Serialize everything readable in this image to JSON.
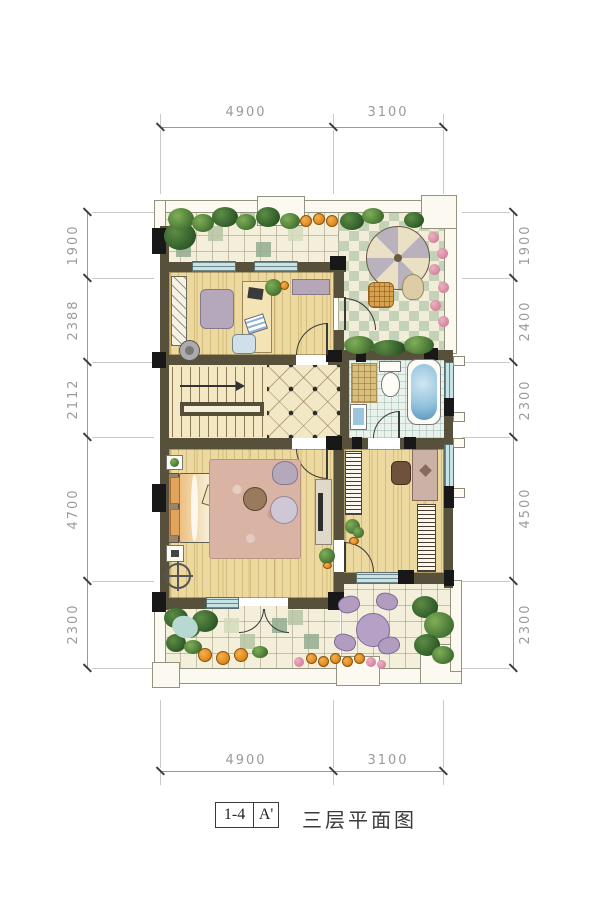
{
  "title": {
    "index_label": "1-4",
    "section_label": "A'",
    "plan_name": "三层平面图"
  },
  "dimensions": {
    "top": [
      "4900",
      "3100"
    ],
    "bottom": [
      "4900",
      "3100"
    ],
    "left": [
      "1900",
      "2388",
      "2112",
      "4700",
      "2300"
    ],
    "right": [
      "1900",
      "2400",
      "2300",
      "4500",
      "2300"
    ]
  },
  "colors": {
    "wall": "#57503a",
    "column": "#181818",
    "wood_floor": "#ecd9a0",
    "terrace_tile": "#f4efdb",
    "checker_tile": "#c4d2b8",
    "window_glass": "#c6e3e6",
    "bath_water": "#8fc0dd",
    "foliage": "#4e7c38",
    "rug": "#d9b3a4",
    "garden_furniture": "#b7a0c6",
    "dimension_text": "#9b9b9b"
  }
}
